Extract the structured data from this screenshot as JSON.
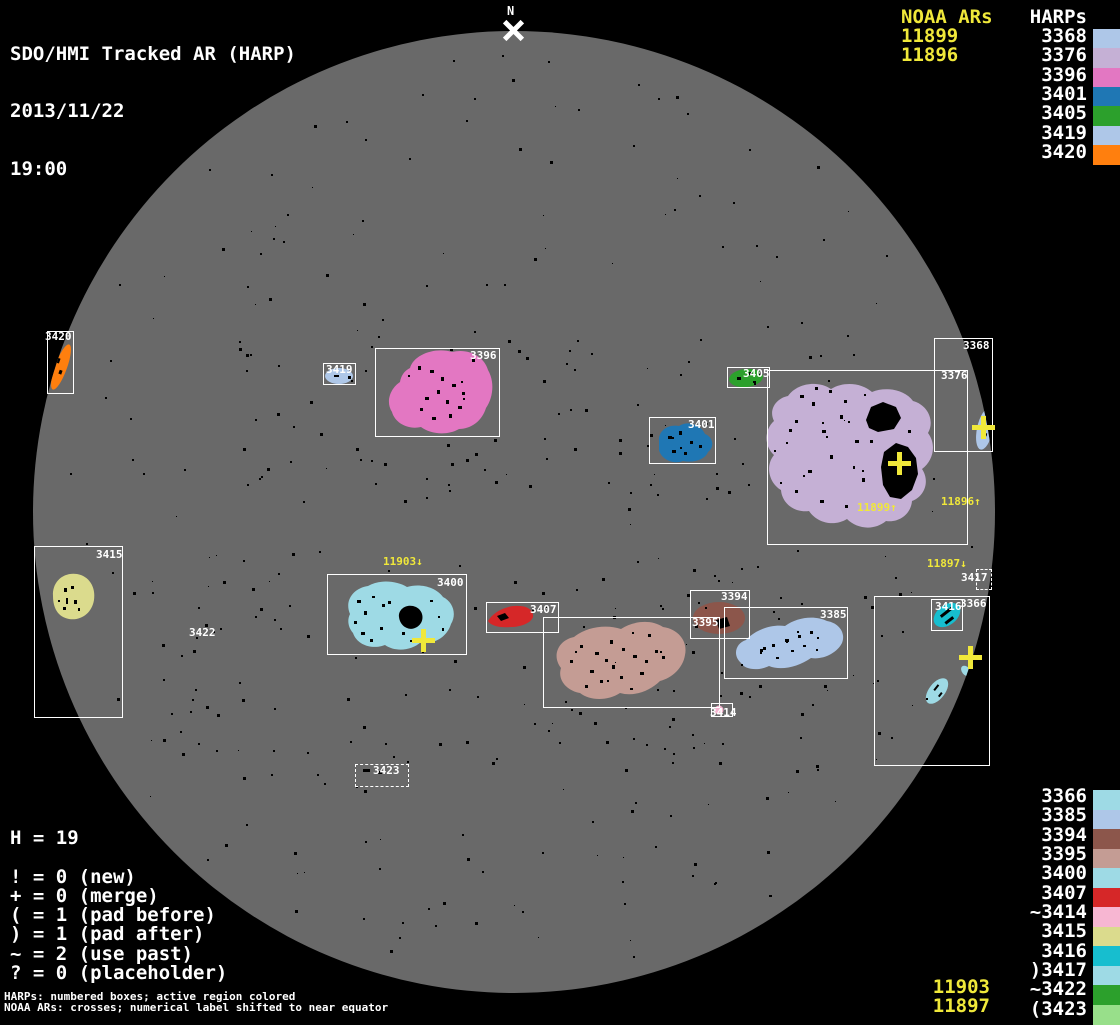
{
  "header": {
    "title": "SDO/HMI Tracked AR (HARP)",
    "date": "2013/11/22",
    "time": "19:00"
  },
  "north_marker": {
    "label": "N"
  },
  "legend_top": {
    "noaa_header": "NOAA ARs",
    "harp_header": "HARPs",
    "noaa_items": [
      {
        "label": "11899"
      },
      {
        "label": "11896"
      }
    ],
    "harp_items": [
      {
        "label": "3368",
        "color": "#aec7e8"
      },
      {
        "label": "3376",
        "color": "#c5b0d5"
      },
      {
        "label": "3396",
        "color": "#e377c2"
      },
      {
        "label": "3401",
        "color": "#1f77b4"
      },
      {
        "label": "3405",
        "color": "#2ca02c"
      },
      {
        "label": "3419",
        "color": "#aec7e8"
      },
      {
        "label": "3420",
        "color": "#ff7f0e"
      }
    ]
  },
  "legend_bottom": {
    "harp_items": [
      {
        "label": "3366",
        "color": "#9edae5"
      },
      {
        "label": "3385",
        "color": "#aec7e8"
      },
      {
        "label": "3394",
        "color": "#8c564b"
      },
      {
        "label": "3395",
        "color": "#c49c94"
      },
      {
        "label": "3400",
        "color": "#9edae5"
      },
      {
        "label": "3407",
        "color": "#d62728"
      },
      {
        "label": "~3414",
        "color": "#f7b6d2"
      },
      {
        "label": "3415",
        "color": "#dbdb8d"
      },
      {
        "label": "3416",
        "color": "#17becf"
      },
      {
        "label": ")3417",
        "color": "#9edae5"
      },
      {
        "label": "~3422",
        "color": "#2ca02c"
      },
      {
        "label": "(3423",
        "color": "#98df8a"
      }
    ],
    "noaa_items": [
      {
        "label": "11903"
      },
      {
        "label": "11897"
      }
    ]
  },
  "stats": {
    "harp_count": "H = 19",
    "lines": [
      "! = 0 (new)",
      "+ = 0 (merge)",
      "( = 1 (pad before)",
      ") = 1 (pad after)",
      "~ = 2 (use past)",
      "? = 0 (placeholder)"
    ]
  },
  "footnotes": [
    "HARPs: numbered boxes; active region colored",
    "NOAA ARs: crosses; numerical label shifted to near equator"
  ],
  "colors": {
    "background": "#000000",
    "disk": "#696969",
    "box_border": "#ffffff",
    "text": "#ffffff",
    "noaa_yellow": "#f0e83a",
    "sunspot": "#000000"
  },
  "chart_data": {
    "type": "scatter",
    "title": "SDO/HMI Tracked AR (HARP)",
    "datetime": "2013/11/22 19:00",
    "coordinate_space": "image pixels (1120x1024); solar disk center (514,512), radius 481",
    "harps": [
      {
        "id": "3368",
        "color": "#aec7e8",
        "box": [
          934,
          338,
          59,
          114
        ],
        "box_style": "solid",
        "label_pos": [
          963,
          340
        ]
      },
      {
        "id": "3376",
        "color": "#c5b0d5",
        "box": [
          767,
          370,
          201,
          175
        ],
        "box_style": "solid",
        "label_pos": [
          941,
          370
        ]
      },
      {
        "id": "3396",
        "color": "#e377c2",
        "box": [
          375,
          348,
          125,
          89
        ],
        "box_style": "solid",
        "label_pos": [
          470,
          350
        ]
      },
      {
        "id": "3401",
        "color": "#1f77b4",
        "box": [
          649,
          417,
          67,
          47
        ],
        "box_style": "solid",
        "label_pos": [
          688,
          419
        ]
      },
      {
        "id": "3405",
        "color": "#2ca02c",
        "box": [
          727,
          367,
          43,
          21
        ],
        "box_style": "solid",
        "label_pos": [
          743,
          368
        ]
      },
      {
        "id": "3419",
        "color": "#aec7e8",
        "box": [
          323,
          363,
          33,
          22
        ],
        "box_style": "solid",
        "label_pos": [
          326,
          364
        ]
      },
      {
        "id": "3420",
        "color": "#ff7f0e",
        "box": [
          47,
          331,
          27,
          63
        ],
        "box_style": "solid",
        "label_pos": [
          45,
          331
        ]
      },
      {
        "id": "3366",
        "color": "#9edae5",
        "box": [
          874,
          596,
          116,
          170
        ],
        "box_style": "solid",
        "label_pos": [
          960,
          598
        ]
      },
      {
        "id": "3385",
        "color": "#aec7e8",
        "box": [
          724,
          607,
          124,
          72
        ],
        "box_style": "solid",
        "label_pos": [
          820,
          609
        ]
      },
      {
        "id": "3394",
        "color": "#8c564b",
        "box": [
          690,
          590,
          60,
          49
        ],
        "box_style": "solid",
        "label_pos": [
          721,
          591
        ]
      },
      {
        "id": "3395",
        "color": "#c49c94",
        "box": [
          543,
          617,
          177,
          91
        ],
        "box_style": "solid",
        "label_pos": [
          692,
          617
        ]
      },
      {
        "id": "3400",
        "color": "#9edae5",
        "box": [
          327,
          574,
          140,
          81
        ],
        "box_style": "solid",
        "label_pos": [
          437,
          577
        ]
      },
      {
        "id": "3407",
        "color": "#d62728",
        "box": [
          486,
          602,
          73,
          31
        ],
        "box_style": "solid",
        "label_pos": [
          530,
          604
        ]
      },
      {
        "id": "3414",
        "color": "#f7b6d2",
        "box": [
          711,
          703,
          22,
          14
        ],
        "box_style": "solid",
        "label_pos": [
          710,
          707
        ]
      },
      {
        "id": "3415",
        "color": "#dbdb8d",
        "box": [
          34,
          546,
          89,
          172
        ],
        "box_style": "solid",
        "label_pos": [
          96,
          549
        ]
      },
      {
        "id": "3416",
        "color": "#17becf",
        "box": [
          931,
          599,
          32,
          32
        ],
        "box_style": "solid",
        "label_pos": [
          935,
          601
        ]
      },
      {
        "id": "3417",
        "color": "#9edae5",
        "box": [
          976,
          569,
          16,
          21
        ],
        "box_style": "dashed",
        "label_pos": [
          961,
          572
        ]
      },
      {
        "id": "3422",
        "color": "#2ca02c",
        "box": [
          189,
          627,
          0,
          0
        ],
        "box_style": "none",
        "label_pos": [
          189,
          627
        ]
      },
      {
        "id": "3423",
        "color": "#98df8a",
        "box": [
          355,
          764,
          54,
          23
        ],
        "box_style": "dashed",
        "label_pos": [
          373,
          765
        ]
      }
    ],
    "noaa_ars": [
      {
        "id": "11899",
        "cross": [
          899,
          463
        ],
        "label": "11899↑",
        "label_pos": [
          857,
          502
        ]
      },
      {
        "id": "11896",
        "cross": [
          983,
          427
        ],
        "label": "11896↑",
        "label_pos": [
          941,
          496
        ]
      },
      {
        "id": "11903",
        "cross": [
          423,
          640
        ],
        "label": "11903↓",
        "label_pos": [
          383,
          556
        ]
      },
      {
        "id": "11897",
        "cross": [
          970,
          657
        ],
        "label": "11897↓",
        "label_pos": [
          927,
          558
        ]
      }
    ],
    "counts": {
      "H": 19,
      "new": 0,
      "merge": 0,
      "pad_before": 1,
      "pad_after": 1,
      "use_past": 2,
      "placeholder": 0
    }
  }
}
